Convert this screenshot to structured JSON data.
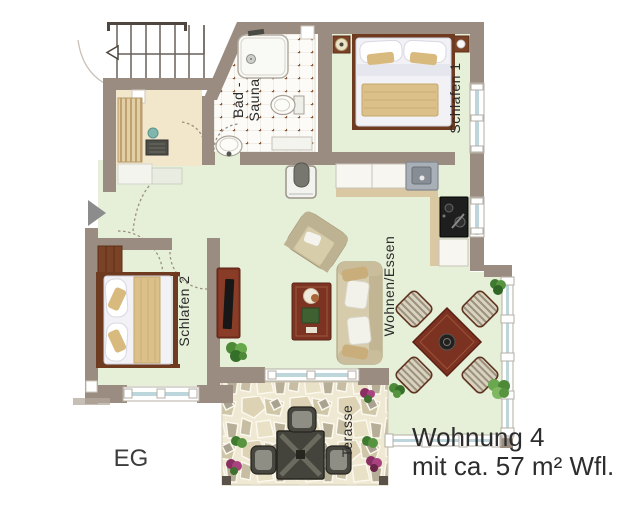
{
  "plan": {
    "floor_label": "EG",
    "caption": {
      "line1": "Wohnung 4",
      "line2": "mit ca. 57 m² Wfl."
    },
    "rooms": {
      "bath": {
        "line1": "Bad -",
        "line2": "Sauna"
      },
      "bedroom1": {
        "label": "Schlafen 1"
      },
      "bedroom2": {
        "label": "Schlafen 2"
      },
      "living": {
        "label": "Wohnen/Essen"
      },
      "terrace": {
        "label": "Terasse"
      }
    },
    "colors": {
      "wall": "#9a8c80",
      "floor_main": "#e6f0d8",
      "floor_sauna": "#f2e6cb",
      "floor_bath": "#fbfaf6",
      "terrace_stone": "#efe8d2",
      "wood_dark": "#7c3322",
      "linen": "#f1f1f6",
      "blanket": "#dcc08a",
      "upholstery": "#d6cbaa",
      "glass": "#bcd6db",
      "text": "#2d2d2d"
    },
    "fixtures": [
      "staircase",
      "entrance-arrow",
      "door-swing",
      "window",
      "shower",
      "toilet",
      "washbasin",
      "sauna-bench",
      "sauna-heater",
      "kitchen-counter",
      "kitchen-sink",
      "stove",
      "tiled-oven",
      "double-bed",
      "wardrobe",
      "nightstand",
      "bedside-lamp",
      "sofa",
      "armchair",
      "coffee-table",
      "tv-sideboard",
      "plant",
      "dining-table",
      "dining-chair",
      "terrace-table",
      "terrace-chair",
      "flower-pot"
    ]
  }
}
